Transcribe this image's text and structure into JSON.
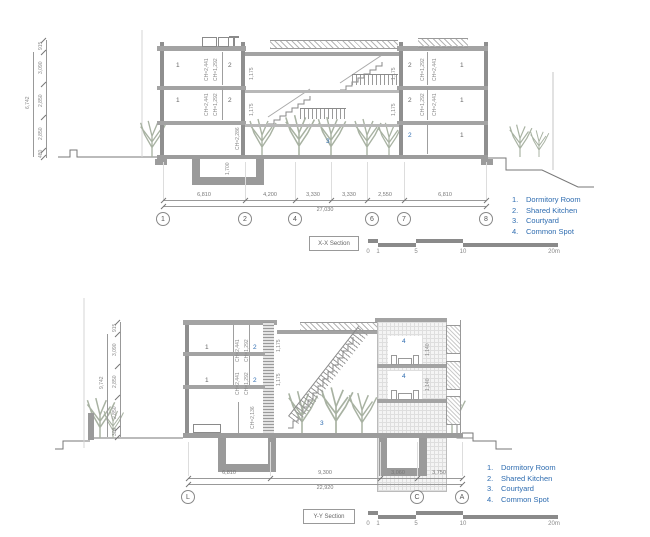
{
  "colors": {
    "accent_blue": "#2e6cb0",
    "line_gray": "#8a8a8a"
  },
  "legend": {
    "items": [
      {
        "num": "1.",
        "label": "Dormitory Room"
      },
      {
        "num": "2.",
        "label": "Shared Kitchen"
      },
      {
        "num": "3.",
        "label": "Courtyard"
      },
      {
        "num": "4.",
        "label": "Common Spot"
      }
    ]
  },
  "scalebar": {
    "labels": [
      "0",
      "1",
      "5",
      "10",
      "20m"
    ]
  },
  "xx": {
    "title": "X-X Section",
    "vdims": [
      "915",
      "3,090",
      "2,850",
      "2,850",
      "480"
    ],
    "voverall": "6,742",
    "dims": [
      "6,810",
      "4,200",
      "3,330",
      "3,330",
      "2,550",
      "6,810"
    ],
    "dims_total": "27,030",
    "bubbles": [
      "1",
      "2",
      "4",
      "6",
      "7",
      "8"
    ],
    "rooms": {
      "dorm": "1",
      "kitchen": "2",
      "courtyard": "3"
    },
    "annot": {
      "ch_dorm": "CH=2,441",
      "ch_kitchen": "CH=1,292",
      "ch_hall": "CH=2,286",
      "pit_depth": "1,700",
      "stair_w": "1,175"
    }
  },
  "yy": {
    "title": "Y-Y Section",
    "vdims": [
      "915",
      "3,090",
      "2,850",
      "2,850",
      "300"
    ],
    "voverall": "9,742",
    "dims": [
      "6,810",
      "9,300",
      "3,060",
      "3,750"
    ],
    "dims_total": "22,920",
    "bubbles": [
      "L",
      "C",
      "A"
    ],
    "rooms": {
      "dorm": "1",
      "kitchen": "2",
      "courtyard": "3",
      "common": "4"
    },
    "annot": {
      "ch_dorm": "CH=2,441",
      "ch_kitchen": "CH=1,292",
      "ch_gf": "CH=2,136",
      "common_h": "1,140",
      "stair_w": "1,175"
    }
  }
}
